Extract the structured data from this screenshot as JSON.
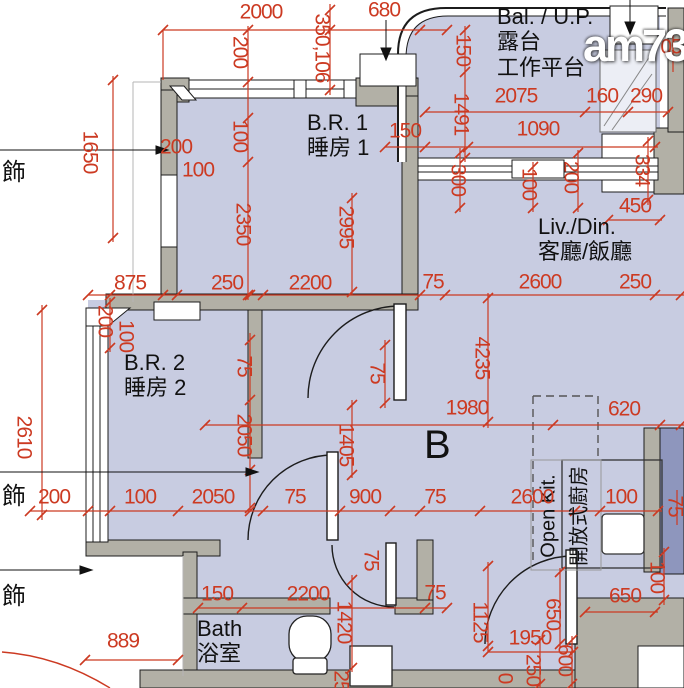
{
  "watermark": "am730",
  "colors": {
    "dimension_red": "#cc3a22",
    "floor_fill": "#c8cce1",
    "wall_gray": "#b2b0a6",
    "duct_blue": "#8e96bd"
  },
  "room_labels": [
    {
      "name": "room-label-balcony",
      "lines": [
        "Bal. / U.P.",
        "露台",
        "工作平台"
      ],
      "x": 497,
      "y": 4,
      "size": 22
    },
    {
      "name": "room-label-bedroom1",
      "lines": [
        "B.R. 1",
        "睡房 1"
      ],
      "x": 307,
      "y": 110,
      "size": 22
    },
    {
      "name": "room-label-livdin",
      "lines": [
        "Liv./Din.",
        "客廳/飯廳"
      ],
      "x": 538,
      "y": 214,
      "size": 22
    },
    {
      "name": "room-label-bedroom2",
      "lines": [
        "B.R. 2",
        "睡房 2"
      ],
      "x": 124,
      "y": 350,
      "size": 22
    },
    {
      "name": "room-label-bath",
      "lines": [
        "Bath",
        "浴室"
      ],
      "x": 197,
      "y": 616,
      "size": 22
    },
    {
      "name": "unit-label",
      "lines": [
        "B"
      ],
      "x": 424,
      "y": 422,
      "size": 40
    },
    {
      "name": "room-label-openkit-en",
      "lines": [
        "Open Kit."
      ],
      "x": 549,
      "y": 516,
      "size": 20,
      "vertical": true
    },
    {
      "name": "room-label-openkit-zh",
      "lines": [
        "開放式廚房"
      ],
      "x": 580,
      "y": 516,
      "size": 20,
      "vertical": true
    }
  ],
  "deco_labels": [
    {
      "text": "飾",
      "x": 2,
      "y": 152
    },
    {
      "text": "飾",
      "x": 2,
      "y": 476
    },
    {
      "text": "飾",
      "x": 2,
      "y": 576
    }
  ],
  "dimensions": [
    {
      "t": "2000",
      "x": 261,
      "y": 12,
      "r": 0
    },
    {
      "t": "680",
      "x": 384,
      "y": 10,
      "r": 0
    },
    {
      "t": "350,106",
      "x": 322,
      "y": 48,
      "r": 1
    },
    {
      "t": "200",
      "x": 240,
      "y": 52,
      "r": 1
    },
    {
      "t": "100",
      "x": 240,
      "y": 136,
      "r": 1
    },
    {
      "t": "150",
      "x": 463,
      "y": 50,
      "r": 1
    },
    {
      "t": "1491",
      "x": 461,
      "y": 114,
      "r": 1
    },
    {
      "t": "2075",
      "x": 516,
      "y": 96,
      "r": 0
    },
    {
      "t": "160",
      "x": 602,
      "y": 96,
      "r": 0
    },
    {
      "t": "290",
      "x": 646,
      "y": 96,
      "r": 0
    },
    {
      "t": "05",
      "x": 671,
      "y": 47,
      "r": 0
    },
    {
      "t": "1090",
      "x": 538,
      "y": 129,
      "r": 0
    },
    {
      "t": "150",
      "x": 405,
      "y": 131,
      "r": 0
    },
    {
      "t": "200",
      "x": 176,
      "y": 147,
      "r": 0
    },
    {
      "t": "100",
      "x": 198,
      "y": 170,
      "r": 0
    },
    {
      "t": "1650",
      "x": 90,
      "y": 152,
      "r": 1
    },
    {
      "t": "300",
      "x": 458,
      "y": 180,
      "r": 1
    },
    {
      "t": "100",
      "x": 529,
      "y": 184,
      "r": 1
    },
    {
      "t": "200",
      "x": 571,
      "y": 177,
      "r": 1
    },
    {
      "t": "334",
      "x": 642,
      "y": 170,
      "r": 1
    },
    {
      "t": "450",
      "x": 635,
      "y": 206,
      "r": 0
    },
    {
      "t": "2350",
      "x": 243,
      "y": 224,
      "r": 1
    },
    {
      "t": "2995",
      "x": 346,
      "y": 227,
      "r": 1
    },
    {
      "t": "875",
      "x": 130,
      "y": 283,
      "r": 0
    },
    {
      "t": "250",
      "x": 227,
      "y": 283,
      "r": 0
    },
    {
      "t": "2200",
      "x": 310,
      "y": 283,
      "r": 0
    },
    {
      "t": "75",
      "x": 433,
      "y": 282,
      "r": 0
    },
    {
      "t": "2600",
      "x": 540,
      "y": 282,
      "r": 0
    },
    {
      "t": "250",
      "x": 635,
      "y": 282,
      "r": 0
    },
    {
      "t": "200",
      "x": 105,
      "y": 321,
      "r": 1
    },
    {
      "t": "100",
      "x": 126,
      "y": 336,
      "r": 1
    },
    {
      "t": "2610",
      "x": 24,
      "y": 437,
      "r": 1
    },
    {
      "t": "75",
      "x": 244,
      "y": 366,
      "r": 1
    },
    {
      "t": "2050",
      "x": 244,
      "y": 435,
      "r": 1
    },
    {
      "t": "1405",
      "x": 346,
      "y": 445,
      "r": 1
    },
    {
      "t": "75",
      "x": 377,
      "y": 373,
      "r": 1
    },
    {
      "t": "4235",
      "x": 482,
      "y": 358,
      "r": 1
    },
    {
      "t": "1980",
      "x": 467,
      "y": 408,
      "r": 0
    },
    {
      "t": "620",
      "x": 624,
      "y": 409,
      "r": 0
    },
    {
      "t": "200",
      "x": 54,
      "y": 497,
      "r": 0
    },
    {
      "t": "100",
      "x": 140,
      "y": 497,
      "r": 0
    },
    {
      "t": "2050",
      "x": 213,
      "y": 497,
      "r": 0
    },
    {
      "t": "75",
      "x": 295,
      "y": 497,
      "r": 0
    },
    {
      "t": "900",
      "x": 365,
      "y": 497,
      "r": 0
    },
    {
      "t": "75",
      "x": 435,
      "y": 497,
      "r": 0
    },
    {
      "t": "2600",
      "x": 532,
      "y": 497,
      "r": 0
    },
    {
      "t": "100",
      "x": 621,
      "y": 497,
      "r": 0
    },
    {
      "t": "75",
      "x": 371,
      "y": 560,
      "r": 1
    },
    {
      "t": "100",
      "x": 657,
      "y": 577,
      "r": 1
    },
    {
      "t": "75",
      "x": 675,
      "y": 506,
      "r": 1
    },
    {
      "t": "150",
      "x": 217,
      "y": 594,
      "r": 0
    },
    {
      "t": "2200",
      "x": 308,
      "y": 594,
      "r": 0
    },
    {
      "t": "75",
      "x": 435,
      "y": 593,
      "r": 0
    },
    {
      "t": "650",
      "x": 625,
      "y": 596,
      "r": 0
    },
    {
      "t": "650",
      "x": 553,
      "y": 614,
      "r": 1
    },
    {
      "t": "1420",
      "x": 344,
      "y": 622,
      "r": 1
    },
    {
      "t": "1125",
      "x": 480,
      "y": 622,
      "r": 1
    },
    {
      "t": "1950",
      "x": 530,
      "y": 638,
      "r": 0
    },
    {
      "t": "889",
      "x": 123,
      "y": 641,
      "r": 0
    },
    {
      "t": "250",
      "x": 533,
      "y": 670,
      "r": 1
    },
    {
      "t": "600",
      "x": 565,
      "y": 660,
      "r": 1
    },
    {
      "t": "25",
      "x": 341,
      "y": 681,
      "r": 1
    },
    {
      "t": "0",
      "x": 505,
      "y": 678,
      "r": 1
    }
  ]
}
